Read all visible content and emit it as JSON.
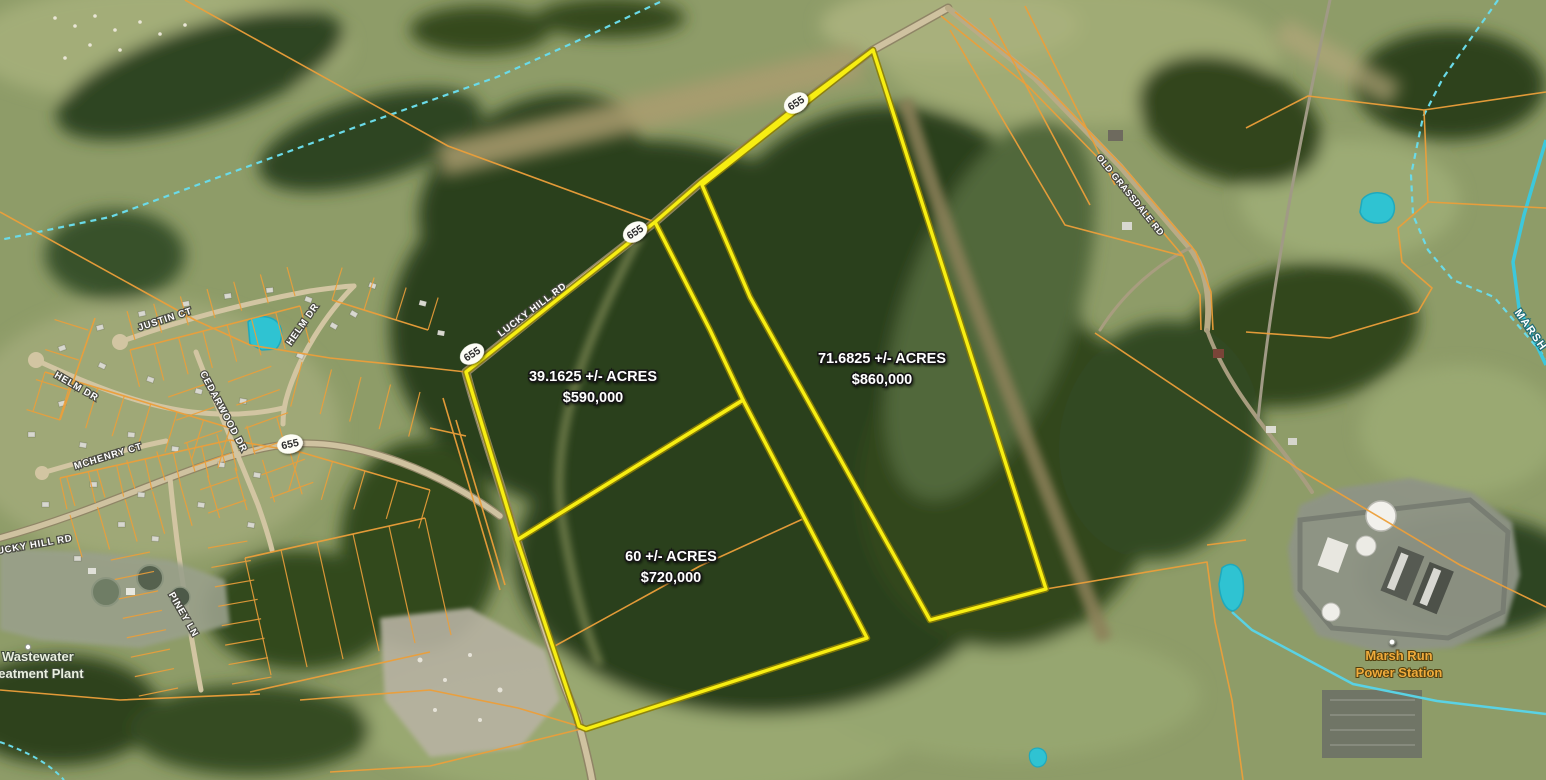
{
  "map_overlay": {
    "parcels": [
      {
        "name": "39-acre-parcel",
        "acres_line": "39.1625 +/- ACRES",
        "price_line": "$590,000"
      },
      {
        "name": "60-acre-parcel",
        "acres_line": "60 +/- ACRES",
        "price_line": "$720,000"
      },
      {
        "name": "71-acre-parcel",
        "acres_line": "71.6825 +/- ACRES",
        "price_line": "$860,000"
      }
    ]
  },
  "roads": {
    "labels": [
      {
        "name": "justin-ct",
        "text": "JUSTIN CT"
      },
      {
        "name": "helm-dr-west",
        "text": "HELM DR"
      },
      {
        "name": "helm-dr-east",
        "text": "HELM DR"
      },
      {
        "name": "cedarwood-dr",
        "text": "CEDARWOOD DR"
      },
      {
        "name": "mchenry-ct",
        "text": "MCHENRY CT"
      },
      {
        "name": "lucky-hill-rd-west",
        "text": "LUCKY HILL RD"
      },
      {
        "name": "lucky-hill-rd-main",
        "text": "LUCKY HILL RD"
      },
      {
        "name": "piney-ln",
        "text": "PINEY LN"
      },
      {
        "name": "old-grassdale-rd",
        "text": "OLD GRASSDALE RD"
      }
    ],
    "route_shields": [
      {
        "text": "655"
      },
      {
        "text": "655"
      },
      {
        "text": "655"
      },
      {
        "text": "655"
      }
    ]
  },
  "water": {
    "stream_label": "MARSH"
  },
  "places": [
    {
      "name": "wastewater-treatment-plant",
      "line1": "Wastewater",
      "line2": "Treatment Plant"
    },
    {
      "name": "marsh-run-power-station",
      "line1": "Marsh Run",
      "line2": "Power Station"
    }
  ],
  "colors": {
    "listing_boundary": "#f7ee12",
    "parcel_lines": "#ec9f3a",
    "stream": "#5ad2e4",
    "pond_fill": "#2fc3d2"
  }
}
